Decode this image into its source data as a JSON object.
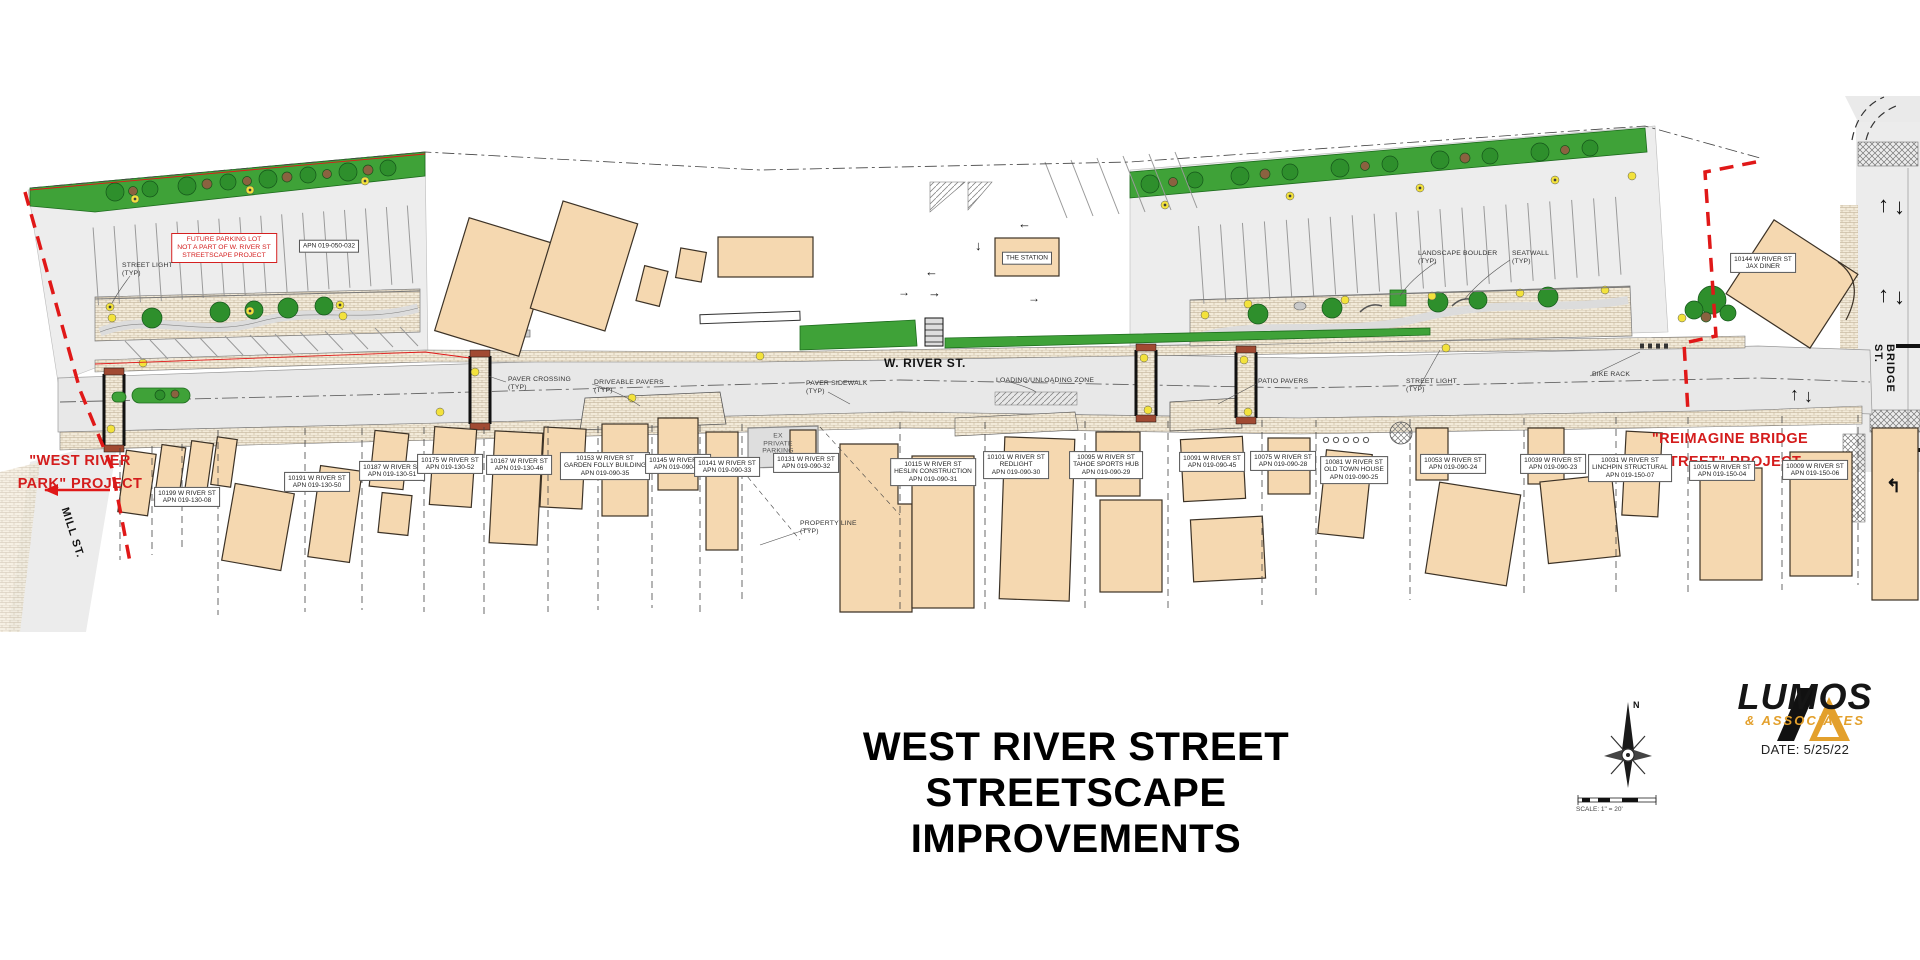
{
  "plan": {
    "street_main": "W. RIVER ST.",
    "street_left": "MILL ST.",
    "street_right": "BRIDGE ST.",
    "west_callout_line1": "\"WEST RIVER",
    "west_callout_line2": "PARK\" PROJECT",
    "east_callout_line1": "\"REIMAGINE BRIDGE",
    "east_callout_line2": "STREET\" PROJECT",
    "future_lot_note_line1": "FUTURE PARKING LOT",
    "future_lot_note_line2": "NOT A PART OF W. RIVER ST",
    "future_lot_note_line3": "STREETSCAPE PROJECT"
  },
  "annotations": [
    {
      "lines": [
        "STREET LIGHT",
        "(TYP)"
      ],
      "x": 122,
      "y": 262
    },
    {
      "lines": [
        "PAVER CROSSING",
        "(TYP)"
      ],
      "x": 508,
      "y": 376
    },
    {
      "lines": [
        "DRIVEABLE PAVERS",
        "(TYP)"
      ],
      "x": 594,
      "y": 379
    },
    {
      "lines": [
        "PAVER SIDEWALK",
        "(TYP)"
      ],
      "x": 806,
      "y": 380
    },
    {
      "lines": [
        "LOADING/UNLOADING ZONE"
      ],
      "x": 996,
      "y": 377
    },
    {
      "lines": [
        "PATIO PAVERS"
      ],
      "x": 1258,
      "y": 378
    },
    {
      "lines": [
        "STREET LIGHT",
        "(TYP)"
      ],
      "x": 1406,
      "y": 378
    },
    {
      "lines": [
        "BIKE RACK"
      ],
      "x": 1592,
      "y": 371
    },
    {
      "lines": [
        "LANDSCAPE BOULDER",
        "(TYP)"
      ],
      "x": 1418,
      "y": 250
    },
    {
      "lines": [
        "SEATWALL",
        "(TYP)"
      ],
      "x": 1512,
      "y": 250
    },
    {
      "lines": [
        "PROPERTY LINE",
        "(TYP)"
      ],
      "x": 800,
      "y": 520
    },
    {
      "lines": [
        "EX",
        "PRIVATE",
        "PARKING"
      ],
      "x": 778,
      "y": 444,
      "align": "center"
    }
  ],
  "parcels": [
    {
      "lines": [
        "10199 W RIVER ST",
        "APN 019-130-08"
      ],
      "x": 187,
      "y": 497
    },
    {
      "lines": [
        "10191 W RIVER ST",
        "APN 019-130-50"
      ],
      "x": 317,
      "y": 482
    },
    {
      "lines": [
        "10187 W RIVER ST",
        "APN 019-130-51"
      ],
      "x": 392,
      "y": 471
    },
    {
      "lines": [
        "10175 W RIVER ST",
        "APN 019-130-52"
      ],
      "x": 450,
      "y": 464
    },
    {
      "lines": [
        "10167 W RIVER ST",
        "APN 019-130-46"
      ],
      "x": 519,
      "y": 465
    },
    {
      "lines": [
        "10153 W RIVER ST",
        "GARDEN FOLLY BUILDING",
        "APN 019-090-35"
      ],
      "x": 605,
      "y": 466
    },
    {
      "lines": [
        "10145 W RIVER ST",
        "APN 019-090-34"
      ],
      "x": 678,
      "y": 464
    },
    {
      "lines": [
        "10141 W RIVER ST",
        "APN 019-090-33"
      ],
      "x": 727,
      "y": 467
    },
    {
      "lines": [
        "10131 W RIVER ST",
        "APN 019-090-32"
      ],
      "x": 806,
      "y": 463
    },
    {
      "lines": [
        "10115 W RIVER ST",
        "HESLIN CONSTRUCTION",
        "APN 019-090-31"
      ],
      "x": 933,
      "y": 472
    },
    {
      "lines": [
        "10101 W RIVER ST",
        "REDLIGHT",
        "APN 019-090-30"
      ],
      "x": 1016,
      "y": 465
    },
    {
      "lines": [
        "10095 W RIVER ST",
        "TAHOE SPORTS HUB",
        "APN 019-090-29"
      ],
      "x": 1106,
      "y": 465
    },
    {
      "lines": [
        "10091 W RIVER ST",
        "APN 019-090-45"
      ],
      "x": 1212,
      "y": 462
    },
    {
      "lines": [
        "10075 W RIVER ST",
        "APN 019-090-28"
      ],
      "x": 1283,
      "y": 461
    },
    {
      "lines": [
        "10081 W RIVER ST",
        "OLD TOWN HOUSE",
        "APN 019-090-25"
      ],
      "x": 1354,
      "y": 470
    },
    {
      "lines": [
        "10053 W RIVER ST",
        "APN 019-090-24"
      ],
      "x": 1453,
      "y": 464
    },
    {
      "lines": [
        "10039 W RIVER ST",
        "APN 019-090-23"
      ],
      "x": 1553,
      "y": 464
    },
    {
      "lines": [
        "10031 W RIVER ST",
        "LINCHPIN STRUCTURAL",
        "APN 019-150-07"
      ],
      "x": 1630,
      "y": 468
    },
    {
      "lines": [
        "10015 W RIVER ST",
        "APN 019-150-04"
      ],
      "x": 1722,
      "y": 471
    },
    {
      "lines": [
        "10009 W RIVER ST",
        "APN 019-150-06"
      ],
      "x": 1815,
      "y": 470
    },
    {
      "lines": [
        "10144 W RIVER ST",
        "JAX DINER"
      ],
      "x": 1763,
      "y": 263
    },
    {
      "lines": [
        "THE STATION"
      ],
      "x": 1027,
      "y": 258
    },
    {
      "lines": [
        "APN 019-050-032"
      ],
      "x": 329,
      "y": 246
    }
  ],
  "titleblock": {
    "title_line1": "WEST RIVER STREET",
    "title_line2": "STREETSCAPE IMPROVEMENTS",
    "company": "LUMOS",
    "company_sub": "& ASSOCIATES",
    "date": "DATE: 5/25/22",
    "scale_text": "SCALE: 1\" = 20'",
    "north_label": "N"
  },
  "colors": {
    "building_fill": "#f5d8b0",
    "landscape_green": "#3fa238",
    "project_red": "#d41c1c",
    "brand_gold": "#e3a02c",
    "road_gray": "#e8e8e8"
  }
}
